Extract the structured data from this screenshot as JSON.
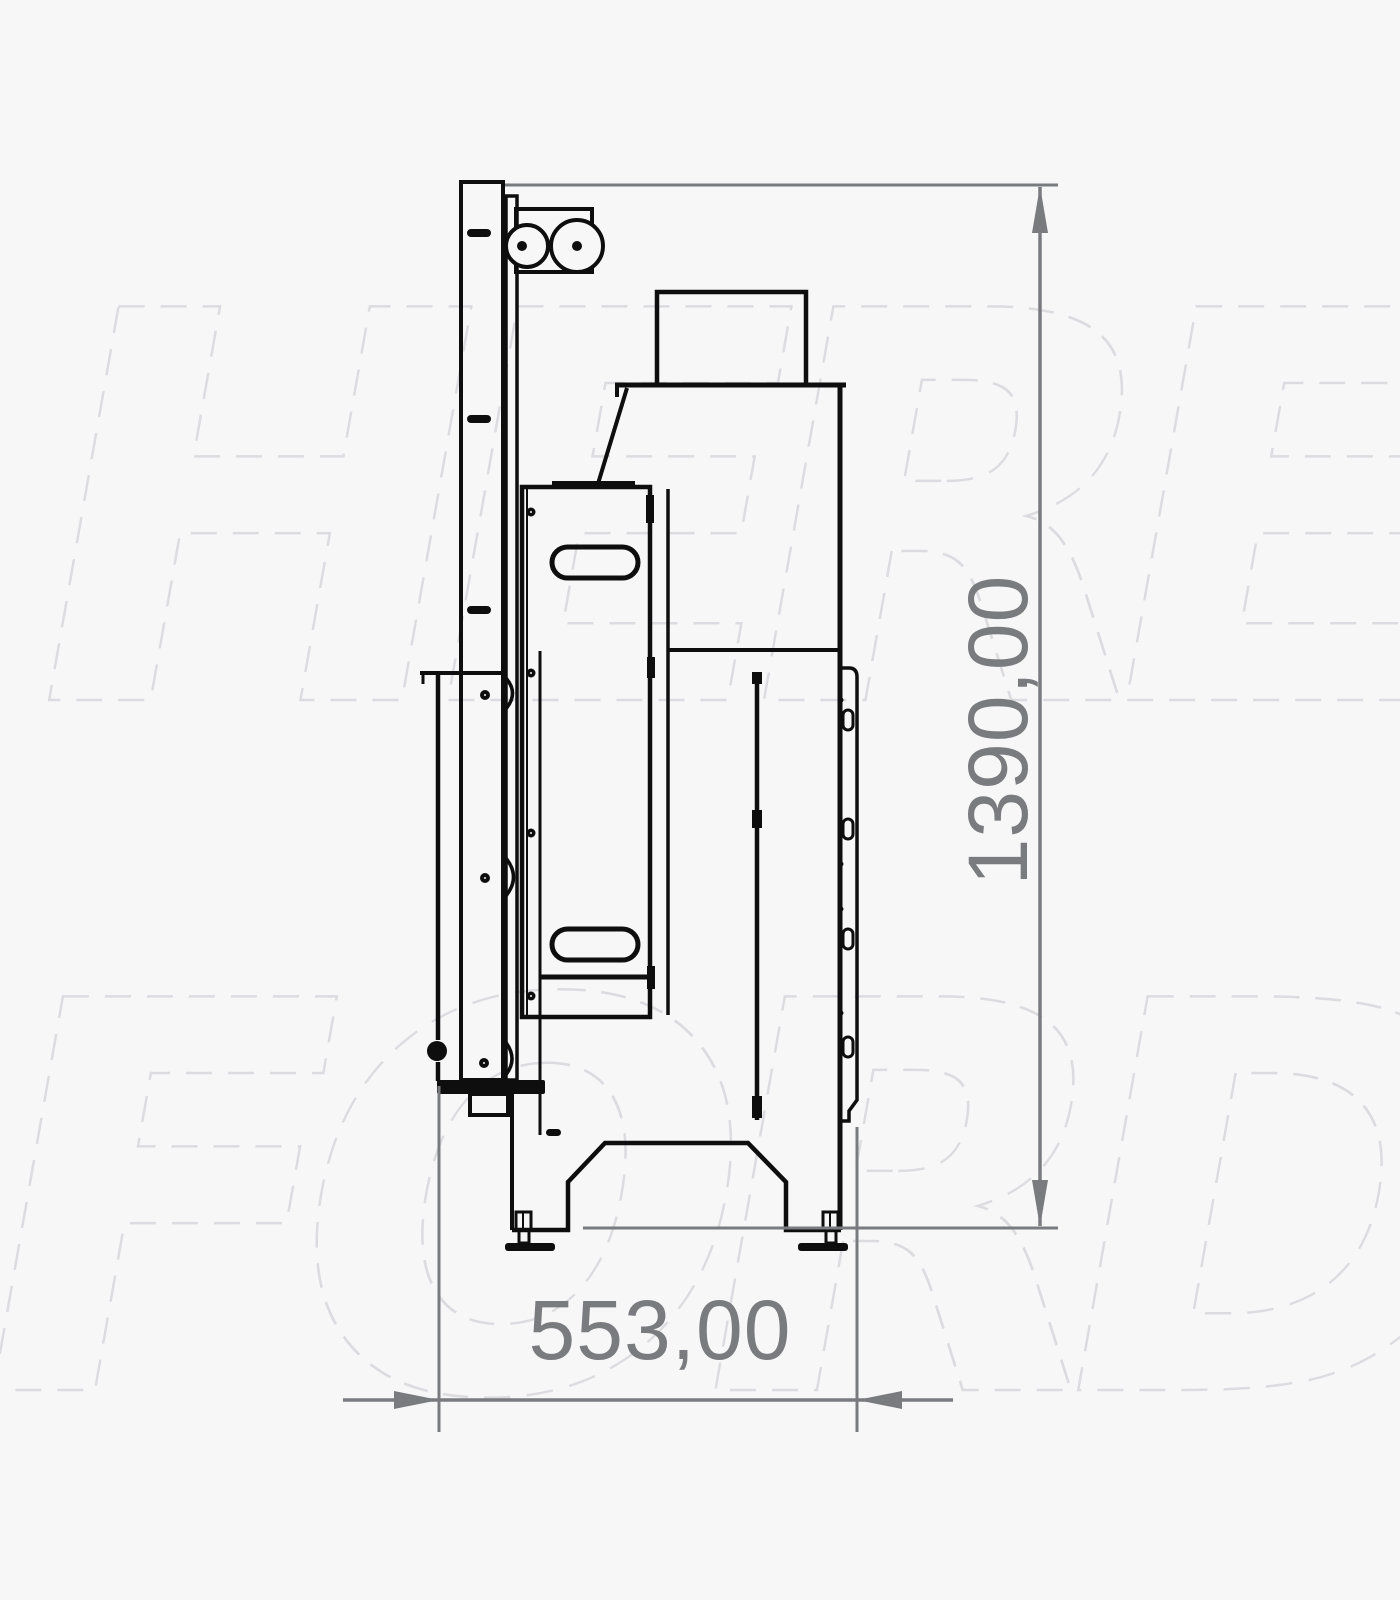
{
  "watermark": {
    "line1": "HERE",
    "line2": "FORD",
    "color": "#dcdce0"
  },
  "dimensions": {
    "height": {
      "label": "1390,00"
    },
    "width": {
      "label": "553,00"
    }
  },
  "colors": {
    "background": "#f7f7f8",
    "ink": "#0e0e0e",
    "dimension": "#7a7b7f",
    "watermark": "#dcdce0"
  }
}
